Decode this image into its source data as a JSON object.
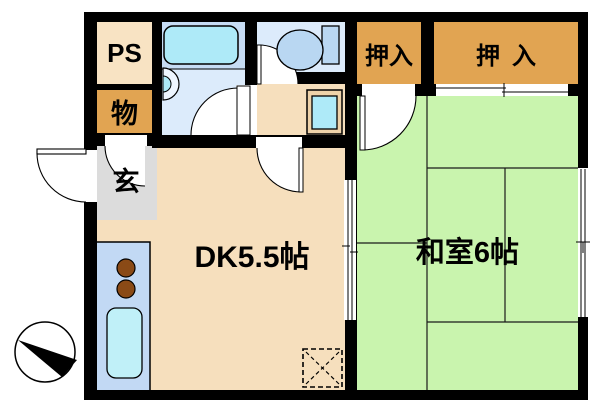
{
  "title": "apartment-floor-plan",
  "rooms": {
    "ps": {
      "label": "PS"
    },
    "storage": {
      "label": "物"
    },
    "entrance": {
      "label": "玄"
    },
    "dining_kitchen": {
      "label": "DK5.5帖"
    },
    "japanese_room": {
      "label": "和室6帖"
    },
    "closet_left": {
      "label": "押入"
    },
    "closet_right": {
      "label": "押入"
    }
  },
  "colors": {
    "wall": "#000000",
    "ps_cream": "#f8e3c3",
    "closet_orange": "#e1a452",
    "entrance_gray": "#dcdcdc",
    "wet_room_blue": "#dcebfb",
    "bath_zone_blue": "#c6dcf4",
    "fixture_cyan": "#aeeaf8",
    "kitchen_blue": "#c2d9f4",
    "fixture_blue": "#b9d7f2",
    "floor_beige": "#f6dfbd",
    "tatami_green": "#c9f4ae",
    "burner_brown": "#8a4a16",
    "pan_tan": "#eed2a9",
    "sink_cyan": "#c0f0f8",
    "basin_white": "#eef6ff"
  },
  "fixtures": {
    "bathtub": "bathtub",
    "washbasin": "washbasin",
    "toilet": "toilet",
    "washing_machine_pan": "washing-machine-pan",
    "stove_burners": "stove-burners",
    "kitchen_sink": "kitchen-sink",
    "refrigerator_space": "refrigerator-space-dashed",
    "compass": "north-arrow-compass"
  }
}
